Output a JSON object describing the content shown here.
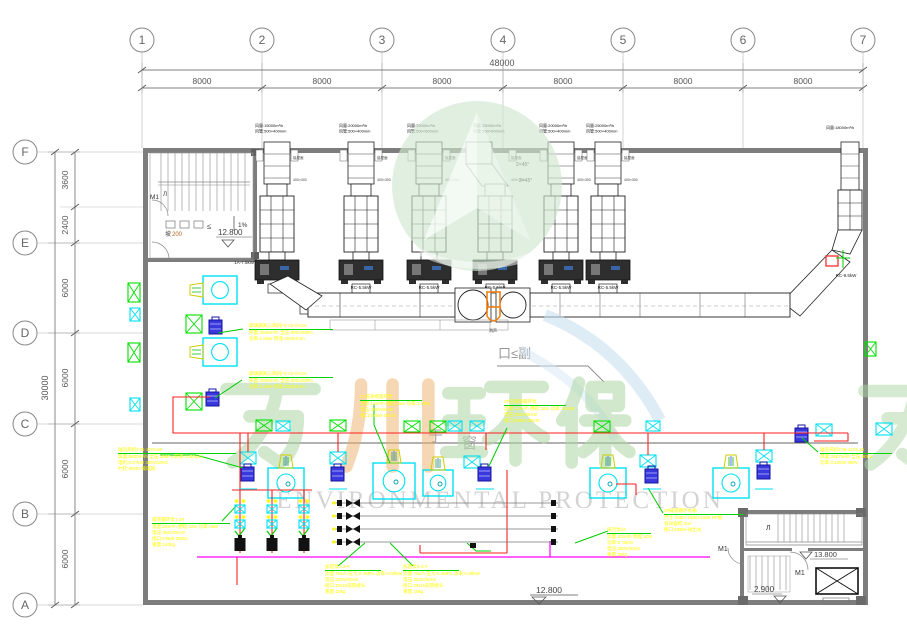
{
  "grid": {
    "cols": [
      "1",
      "2",
      "3",
      "4",
      "5",
      "6",
      "7"
    ],
    "bays": [
      "8000",
      "8000",
      "8000",
      "8000",
      "8000",
      "8000"
    ],
    "total_w": "48000",
    "rows": [
      "F",
      "E",
      "D",
      "C",
      "B",
      "A"
    ],
    "segs": [
      "3600",
      "2400",
      "6000",
      "6000",
      "6000",
      "6000"
    ],
    "total_h": "30000"
  },
  "stacks": [
    {
      "l1": "风量:15000m³/h",
      "l2": "风管:500×400mm",
      "fan": "1A-7.5kW"
    },
    {
      "l1": "风量:20000m³/h",
      "l2": "风管:500×400mm",
      "fan": "RC-5.5kW"
    },
    {
      "l1": "风量:25000m³/h",
      "l2": "风管:500×500mm",
      "fan": "RC-5.5kW"
    },
    {
      "l1": "风量:25000m³/h",
      "l2": "风管:500×500mm",
      "fan": "RC-5.5kW"
    },
    {
      "l1": "风量:20000m³/h",
      "l2": "风管:500×400mm",
      "fan": "RC-5.5kW"
    },
    {
      "l1": "风量:25000m³/h",
      "l2": "风管:500×400mm",
      "fan": "RC-5.5kW"
    }
  ],
  "right_stack": {
    "label": "风量:18000m³/h",
    "fan": "RC-9.5kW"
  },
  "labels": {
    "m1": "M1",
    "stair": "Л",
    "slope_pct": "1%",
    "slope": "坡",
    "slope_val": "200",
    "lte": "≤",
    "elev_tl": "12.800",
    "elev_bc": "12.800",
    "elev_br_up": "13.800",
    "elev_br_low": "2.900",
    "angle1": "2×45°",
    "angle2": "2×45°",
    "silencer": "消声",
    "hollow1": "于",
    "hollow2": "窗",
    "section": "口≤副",
    "roof": "接屋面",
    "duct_sz": "400×300"
  },
  "watermark": {
    "cn": "万川环保",
    "en": "ENVIRONMENTAL PROTECTION"
  },
  "annotations": [
    {
      "title": "轴流风机T35-11#3.55",
      "lines": [
        "风量:5800m³/h 全压:196Pa 转速:1450rpm",
        "电机:0.37kW 380V/50Hz",
        "叶轮:Φ400-玻璃钢"
      ]
    },
    {
      "title": "玻璃钢离心风机F4-72-#3.6A",
      "lines": [
        "风量:3000m³/h 全压:600/450Pa",
        "功率:1.5kW 转速:2900r/min"
      ]
    },
    {
      "title": "玻璃钢离心风机F4-72-#3.6A",
      "lines": [
        "风量:3000m³/h 全压:600/450Pa",
        "功率:1.5kW 转速:2900r/min"
      ]
    },
    {
      "title": "1#洗涤塔循环泵",
      "lines": [
        "流量:12m³/h 扬程:18m 功率:1.5kW",
        "电压:380V/50Hz",
        "接口:DN50-DN40"
      ]
    },
    {
      "title": "2#洗涤塔循环泵",
      "lines": [
        "流量:12m³/h 扬程:18m 功率:1.5kW",
        "电压:380V/50Hz",
        "接口:DN50-DN40"
      ]
    },
    {
      "title": "碱液循环泵1-2#",
      "lines": [
        "流量:25m³/h 扬程:22m 功率:4kW",
        "电压:380V/50Hz",
        "接口:DN65-DN50",
        "重量:140kg"
      ]
    },
    {
      "title": "加药泵1-2-#",
      "lines": [
        "流量:76L/h 压力:0.4MPa 功率:0.09kW",
        "电压:220V/50Hz",
        "接口:DN15软管接头",
        "重量:10kg"
      ]
    },
    {
      "title": "加药泵3-4-#",
      "lines": [
        "流量:76L/h 压力:0.4MPa 功率:0.09kW",
        "电压:220V/50Hz",
        "接口:DN15软管接头",
        "重量:10kg"
      ]
    },
    {
      "title": "排污泵2#",
      "lines": [
        "流量:10m³/h 扬程:10m",
        "功率:0.75kW",
        "电压:380V/50Hz",
        "重量:25kg"
      ]
    },
    {
      "title": "2#碱液循环水箱",
      "lines": [
        "尺寸:2000×1500×1500 PP板",
        "有效容积:4m³",
        "接口:DN65-进出水"
      ]
    },
    {
      "title": "轴流风机T35-11#3.15",
      "lines": [
        "风量:3227m³/h 全压:90Pa",
        "功率:0.18kW 380V"
      ]
    }
  ]
}
